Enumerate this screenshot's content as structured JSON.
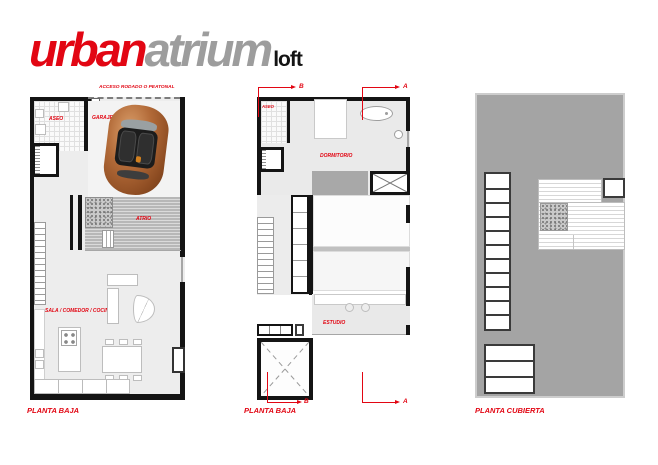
{
  "logo": {
    "part1": "urban",
    "part2": "atrium",
    "part3": "loft"
  },
  "colors": {
    "accent_red": "#e20613",
    "logo_gray": "#9d9d9d",
    "logo_black": "#141414",
    "wall_black": "#141414",
    "floor_gray": "#ededed",
    "roof_gray": "#a4a4a4"
  },
  "plans": {
    "ground": {
      "title": "PLANTA BAJA",
      "access_label": "ACCESO RODADO O PEATONAL",
      "rooms": {
        "aseo": "ASEO",
        "garaje": "GARAJE",
        "atrio": "ATRIO",
        "sala": "SALA / COMEDOR / COCINA"
      }
    },
    "upper": {
      "title": "PLANTA BAJA",
      "rooms": {
        "aseo": "ASEO",
        "dormitorio": "DORMITORIO",
        "estudio": "ESTUDIO"
      },
      "section_markers": {
        "a": "A",
        "b": "B"
      }
    },
    "roof": {
      "title": "PLANTA CUBIERTA"
    }
  }
}
